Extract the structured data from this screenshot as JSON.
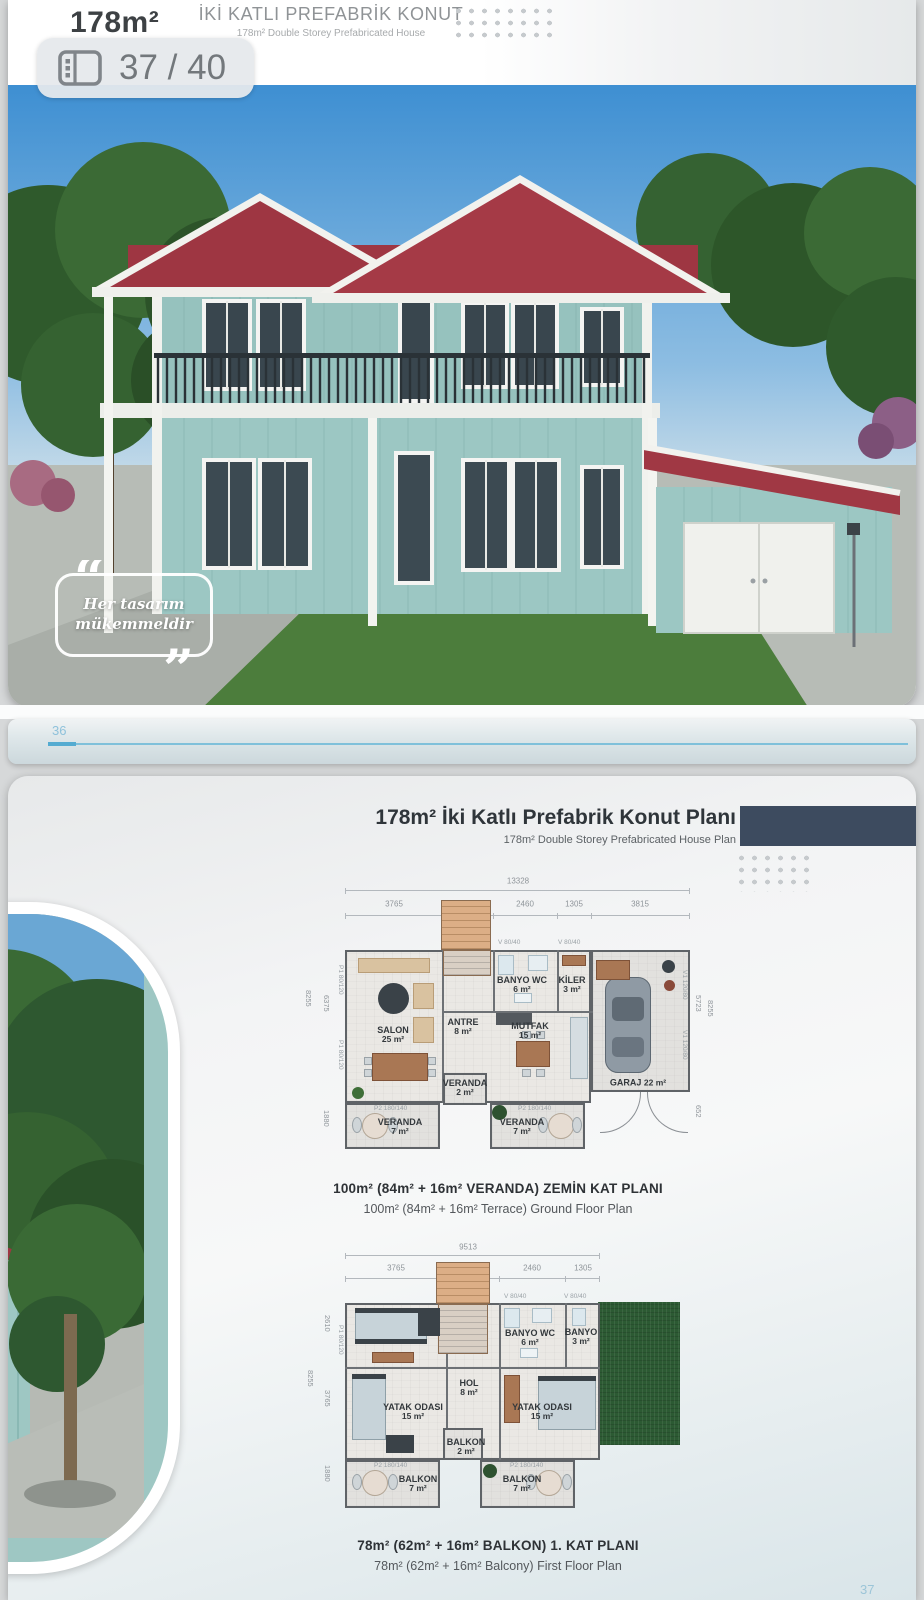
{
  "viewer": {
    "page_indicator": "37 / 40"
  },
  "page1": {
    "header": {
      "area": "178m²",
      "title": "İKİ KATLI PREFABRİK KONUT",
      "subtitle": "178m² Double Storey Prefabricated House"
    },
    "quote": {
      "open": "“",
      "line1": "Her tasarım",
      "line2": "mükemmeldir",
      "close": "”"
    },
    "footer_page_number": "36"
  },
  "page2": {
    "title": "178m² İki Katlı Prefabrik Konut Planı",
    "subtitle": "178m² Double Storey Prefabricated House Plan",
    "ground_plan": {
      "dim_total": "13328",
      "dim_segments": [
        "3765",
        "1982",
        "2460",
        "1305",
        "3815"
      ],
      "dim_left": [
        "8255",
        "6375",
        "1880"
      ],
      "dim_right": [
        "8255",
        "5723",
        "652"
      ],
      "rooms": [
        {
          "name": "SALON",
          "area": "25 m²"
        },
        {
          "name": "ANTRE",
          "area": "8 m²"
        },
        {
          "name": "BANYO WC",
          "area": "6 m²"
        },
        {
          "name": "KİLER",
          "area": "3 m²"
        },
        {
          "name": "MUTFAK",
          "area": "15 m²"
        },
        {
          "name": "VERANDA",
          "area": "2 m²"
        },
        {
          "name": "VERANDA",
          "area": "7 m²"
        },
        {
          "name": "VERANDA",
          "area": "7 m²"
        },
        {
          "name": "GARAJ",
          "area": "22 m²"
        }
      ],
      "labels": {
        "top_windows": [
          "V 80/40",
          "V 80/40"
        ],
        "left_windows": [
          "P1 80/120",
          "P1 80/120"
        ],
        "veranda_doors": [
          "P2 180/140",
          "P2 180/140"
        ],
        "garage_windows": [
          "V1 120/80",
          "V1 120/80"
        ]
      }
    },
    "ground_caption_tr": "100m²  (84m² + 16m²  VERANDA) ZEMİN KAT PLANI",
    "ground_caption_en": "100m² (84m² + 16m² Terrace) Ground Floor Plan",
    "first_plan": {
      "dim_total": "9513",
      "dim_segments": [
        "3765",
        "1983",
        "2460",
        "1305"
      ],
      "dim_left": [
        "8255",
        "2610",
        "3765",
        "1880"
      ],
      "rooms": [
        {
          "name": "BANYO WC",
          "area": "6 m²"
        },
        {
          "name": "BANYO",
          "area": "3 m²"
        },
        {
          "name": "HOL",
          "area": "8 m²"
        },
        {
          "name": "YATAK ODASI",
          "area": "15 m²"
        },
        {
          "name": "YATAK ODASI",
          "area": "15 m²"
        },
        {
          "name": "BALKON",
          "area": "2 m²"
        },
        {
          "name": "BALKON",
          "area": "7 m²"
        },
        {
          "name": "BALKON",
          "area": "7 m²"
        }
      ],
      "labels": {
        "top_windows": [
          "V 80/40",
          "V 80/40"
        ],
        "left_windows": [
          "P1 80/120"
        ],
        "balcony_doors": [
          "P2 180/140",
          "P2 180/140"
        ]
      }
    },
    "first_caption_tr": "78m²  (62m² + 16m²  BALKON) 1. KAT  PLANI",
    "first_caption_en": "78m² (62m² + 16m² Balcony) First Floor Plan",
    "page_number": "37"
  }
}
